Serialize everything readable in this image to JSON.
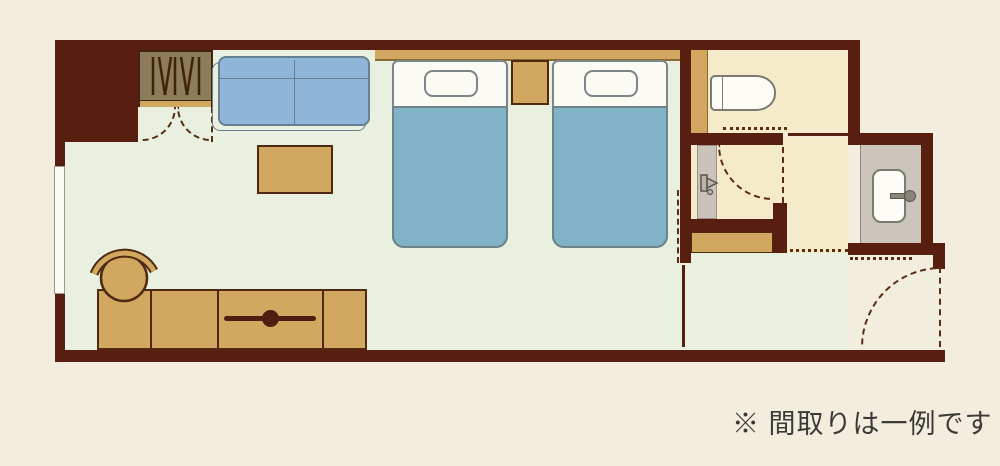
{
  "note": {
    "text": "※ 間取りは一例です"
  },
  "legend": {
    "rooms": [
      "main-bedroom",
      "closet",
      "toilet-room",
      "shower-room",
      "corridor",
      "washbasin-room",
      "entrance"
    ],
    "furniture_icons": [
      "closet-hangers-icon",
      "sofa-icon",
      "low-table-icon",
      "twin-bed-icon",
      "nightstand-icon",
      "tv-counter-icon",
      "stool-icon",
      "toilet-bowl-icon",
      "shower-faucet-icon",
      "washbasin-icon",
      "window-icon",
      "door-swing-icon"
    ]
  },
  "colors": {
    "background": "#f3edde",
    "wall": "#581e0f",
    "bedroom_floor": "#e9f0e0",
    "service_floor": "#f5eaca",
    "entrance_floor": "#f2eedd",
    "wet_area_floor": "#cbc5bb",
    "furniture_tan": "#d2a75f",
    "bed_blue": "#81b3c6",
    "sofa_blue": "#8fb6d8",
    "door_dash": "#5a2c12"
  }
}
